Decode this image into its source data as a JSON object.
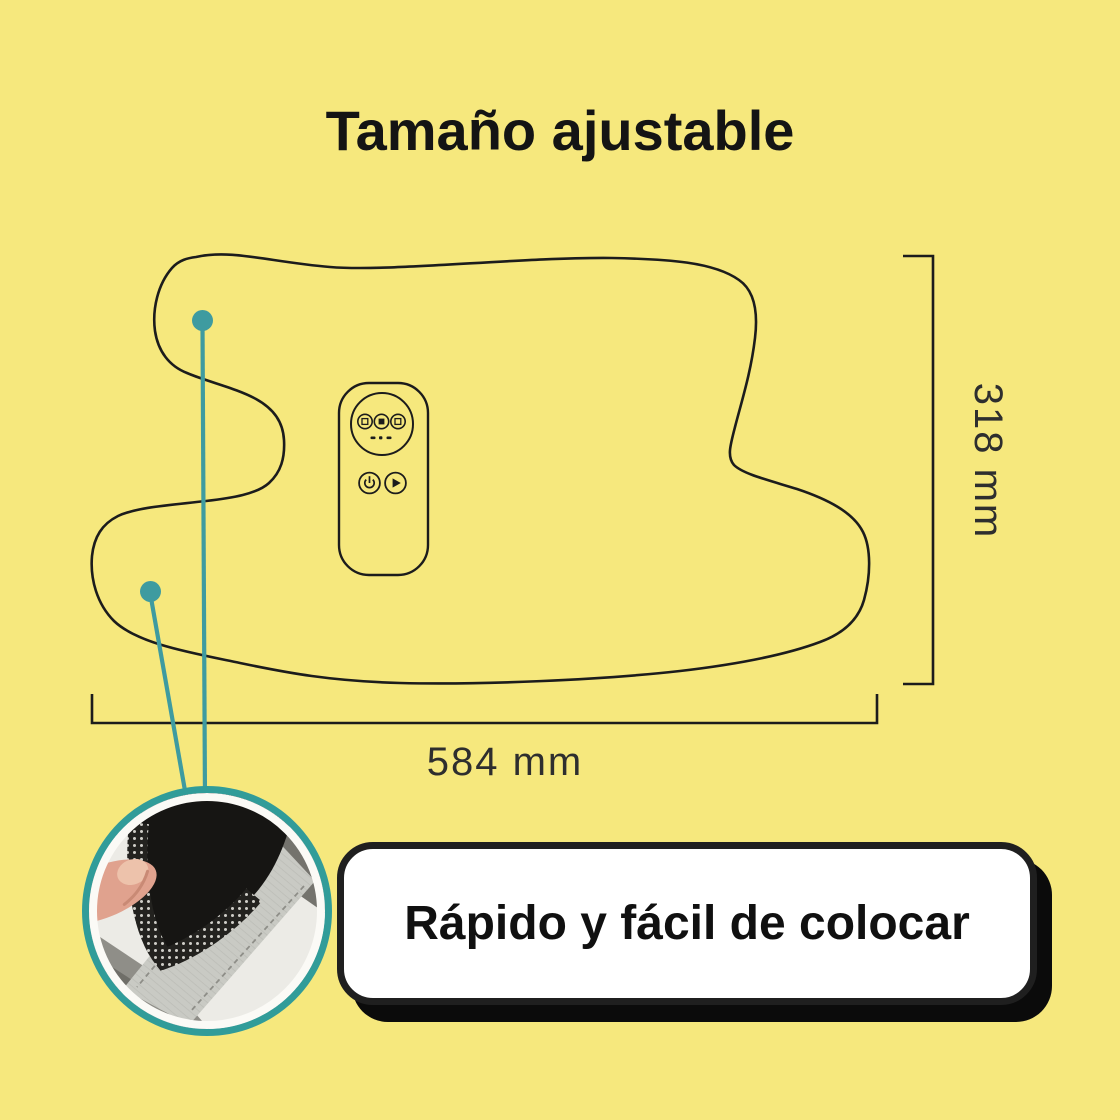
{
  "title": "Tamaño ajustable",
  "diagram": {
    "width_dimension": "584 mm",
    "height_dimension": "318 mm",
    "outline": "heating-pad-top-view-outline",
    "control_panel": {
      "icons": [
        "mode-left-icon",
        "stop-icon",
        "mode-right-icon",
        "power-icon",
        "play-icon"
      ]
    },
    "callout_markers": 2
  },
  "banner": {
    "label": "Rápido y fácil de colocar"
  },
  "inset": {
    "content": "hand-opening-velcro-fastener-photo"
  },
  "colors": {
    "background": "#F6E87D",
    "outline": "#1C1C1C",
    "accent_teal": "#3E9BA0",
    "inset_ring": "#319C99",
    "banner_background": "#FFFFFF",
    "banner_border": "#1F1F1F",
    "banner_shadow": "#0B0B0B",
    "text": "#141414",
    "dimension_text": "#2E2E2E"
  }
}
